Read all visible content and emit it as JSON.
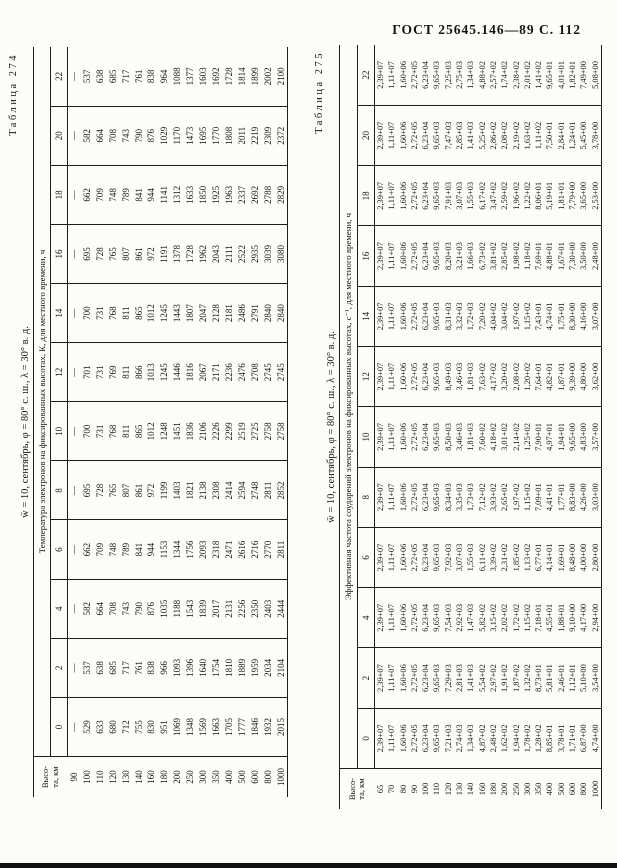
{
  "page_header": "ГОСТ 25645.146—89 С. 112",
  "tables": [
    {
      "caption": "Таблица 274",
      "title": "w̄ = 10, сентябрь, φ = 80° с. ш., λ = 30° в. д.",
      "subtitle": "Температура электронов на фиксированных высотах, К, для местного времени, ч",
      "row_header_line1": "Высо-",
      "row_header_line2": "та, км",
      "hours": [
        "0",
        "2",
        "4",
        "6",
        "8",
        "10",
        "12",
        "14",
        "16",
        "18",
        "20",
        "22"
      ],
      "rows": [
        {
          "alt": "90",
          "values": [
            "—",
            "—",
            "—",
            "—",
            "—",
            "—",
            "—",
            "—",
            "—",
            "—",
            "—",
            "—"
          ]
        },
        {
          "alt": "100",
          "values": [
            "529",
            "537",
            "582",
            "662",
            "695",
            "700",
            "701",
            "700",
            "695",
            "662",
            "582",
            "537"
          ]
        },
        {
          "alt": "110",
          "values": [
            "633",
            "638",
            "664",
            "709",
            "728",
            "731",
            "731",
            "731",
            "728",
            "709",
            "664",
            "638"
          ]
        },
        {
          "alt": "120",
          "values": [
            "680",
            "685",
            "708",
            "748",
            "765",
            "768",
            "769",
            "768",
            "765",
            "748",
            "708",
            "685"
          ]
        },
        {
          "alt": "130",
          "values": [
            "712",
            "717",
            "743",
            "789",
            "807",
            "811",
            "811",
            "811",
            "807",
            "789",
            "743",
            "717"
          ]
        },
        {
          "alt": "140",
          "values": [
            "755",
            "761",
            "790",
            "841",
            "861",
            "865",
            "866",
            "865",
            "861",
            "841",
            "790",
            "761"
          ]
        },
        {
          "alt": "160",
          "values": [
            "830",
            "838",
            "876",
            "944",
            "972",
            "1012",
            "1013",
            "1012",
            "972",
            "944",
            "876",
            "838"
          ]
        },
        {
          "alt": "180",
          "values": [
            "951",
            "966",
            "1035",
            "1153",
            "1199",
            "1248",
            "1245",
            "1245",
            "1191",
            "1141",
            "1029",
            "964"
          ]
        },
        {
          "alt": "200",
          "values": [
            "1069",
            "1093",
            "1188",
            "1344",
            "1403",
            "1451",
            "1446",
            "1443",
            "1378",
            "1312",
            "1170",
            "1088"
          ]
        },
        {
          "alt": "250",
          "values": [
            "1348",
            "1396",
            "1543",
            "1756",
            "1821",
            "1836",
            "1816",
            "1807",
            "1728",
            "1633",
            "1473",
            "1377"
          ]
        },
        {
          "alt": "300",
          "values": [
            "1569",
            "1640",
            "1839",
            "2093",
            "2138",
            "2106",
            "2067",
            "2047",
            "1962",
            "1850",
            "1695",
            "1603"
          ]
        },
        {
          "alt": "350",
          "values": [
            "1663",
            "1754",
            "2017",
            "2318",
            "2308",
            "2226",
            "2171",
            "2128",
            "2043",
            "1925",
            "1770",
            "1692"
          ]
        },
        {
          "alt": "400",
          "values": [
            "1705",
            "1810",
            "2131",
            "2471",
            "2414",
            "2299",
            "2236",
            "2181",
            "2111",
            "1963",
            "1808",
            "1728"
          ]
        },
        {
          "alt": "500",
          "values": [
            "1777",
            "1889",
            "2256",
            "2616",
            "2594",
            "2519",
            "2476",
            "2486",
            "2522",
            "2337",
            "2011",
            "1814"
          ]
        },
        {
          "alt": "600",
          "values": [
            "1846",
            "1959",
            "2350",
            "2716",
            "2748",
            "2725",
            "2708",
            "2791",
            "2935",
            "2692",
            "2219",
            "1899"
          ]
        },
        {
          "alt": "800",
          "values": [
            "1932",
            "2034",
            "2403",
            "2770",
            "2811",
            "2758",
            "2745",
            "2840",
            "3039",
            "2788",
            "2309",
            "2002"
          ]
        },
        {
          "alt": "1000",
          "values": [
            "2015",
            "2104",
            "2444",
            "2811",
            "2852",
            "2758",
            "2745",
            "2840",
            "3080",
            "2829",
            "2372",
            "2100"
          ]
        }
      ]
    },
    {
      "caption": "Таблица 275",
      "title": "w̄ = 10, сентябрь, φ = 80° с. ш., λ = 30° в. д.",
      "subtitle": "Эффективная частота соударений электронов на фиксированных высотах, с⁻¹, для местного времени, ч",
      "row_header_line1": "Высо-",
      "row_header_line2": "та, км",
      "hours": [
        "0",
        "2",
        "4",
        "6",
        "8",
        "10",
        "12",
        "14",
        "16",
        "18",
        "20",
        "22"
      ],
      "rows": [
        {
          "alt": "65",
          "values": [
            "2,39+07",
            "2,39+07",
            "2,39+07",
            "2,39+07",
            "2,39+07",
            "2,39+07",
            "2,39+07",
            "2,39+07",
            "2,39+07",
            "2,39+07",
            "2,39+07",
            "2,39+07"
          ]
        },
        {
          "alt": "70",
          "values": [
            "1,11+07",
            "1,11+07",
            "1,11+07",
            "1,11+07",
            "1,11+07",
            "1,11+07",
            "1,11+07",
            "1,11+07",
            "1,11+07",
            "1,11+07",
            "1,11+07",
            "1,11+07"
          ]
        },
        {
          "alt": "80",
          "values": [
            "1,60+06",
            "1,60+06",
            "1,60+06",
            "1,60+06",
            "1,60+06",
            "1,60+06",
            "1,60+06",
            "1,60+06",
            "1,60+06",
            "1,60+06",
            "1,60+06",
            "1,60+06"
          ]
        },
        {
          "alt": "90",
          "values": [
            "2,72+05",
            "2,72+05",
            "2,72+05",
            "2,72+05",
            "2,72+05",
            "2,72+05",
            "2,72+05",
            "2,72+05",
            "2,72+05",
            "2,72+05",
            "2,72+05",
            "2,72+05"
          ]
        },
        {
          "alt": "100",
          "values": [
            "6,23+04",
            "6,23+04",
            "6,23+04",
            "6,23+04",
            "6,23+04",
            "6,23+04",
            "6,23+04",
            "6,23+04",
            "6,23+04",
            "6,23+04",
            "6,23+04",
            "6,23+04"
          ]
        },
        {
          "alt": "110",
          "values": [
            "9,65+03",
            "9,65+03",
            "9,65+03",
            "9,65+03",
            "9,65+03",
            "9,65+03",
            "9,65+03",
            "9,65+03",
            "9,65+03",
            "9,65+03",
            "9,65+03",
            "9,65+03"
          ]
        },
        {
          "alt": "120",
          "values": [
            "7,21+03",
            "7,29+03",
            "7,54+03",
            "7,92+03",
            "8,34+03",
            "8,50+03",
            "8,49+03",
            "8,31+03",
            "8,20+03",
            "7,91+03",
            "7,47+03",
            "7,25+03"
          ]
        },
        {
          "alt": "130",
          "values": [
            "2,74+03",
            "2,81+03",
            "2,92+03",
            "3,07+03",
            "3,35+03",
            "3,46+03",
            "3,46+03",
            "3,32+03",
            "3,21+03",
            "3,07+03",
            "2,85+03",
            "2,75+03"
          ]
        },
        {
          "alt": "140",
          "values": [
            "1,34+03",
            "1,41+03",
            "1,47+03",
            "1,55+03",
            "1,73+03",
            "1,81+03",
            "1,81+03",
            "1,72+03",
            "1,66+03",
            "1,55+03",
            "1,41+03",
            "1,34+03"
          ]
        },
        {
          "alt": "160",
          "values": [
            "4,87+02",
            "5,54+02",
            "5,82+02",
            "6,11+02",
            "7,12+02",
            "7,60+02",
            "7,63+02",
            "7,20+02",
            "6,73+02",
            "6,17+02",
            "5,25+02",
            "4,88+02"
          ]
        },
        {
          "alt": "180",
          "values": [
            "2,48+02",
            "2,97+02",
            "3,15+02",
            "3,39+02",
            "3,93+02",
            "4,18+02",
            "4,17+02",
            "4,04+02",
            "3,81+02",
            "3,47+02",
            "2,86+02",
            "2,57+02"
          ]
        },
        {
          "alt": "200",
          "values": [
            "1,62+02",
            "1,91+02",
            "2,02+02",
            "2,31+02",
            "2,65+02",
            "3,01+02",
            "3,20+02",
            "3,04+02",
            "2,85+02",
            "2,59+02",
            "2,08+02",
            "1,74+02"
          ]
        },
        {
          "alt": "250",
          "values": [
            "1,94+02",
            "1,87+02",
            "1,72+02",
            "1,85+02",
            "1,97+02",
            "2,14+02",
            "2,08+02",
            "1,97+02",
            "1,98+02",
            "1,96+02",
            "2,19+02",
            "2,38+02"
          ]
        },
        {
          "alt": "300",
          "values": [
            "1,78+02",
            "1,32+02",
            "1,15+02",
            "1,13+02",
            "1,15+02",
            "1,25+02",
            "1,20+02",
            "1,15+02",
            "1,18+02",
            "1,22+02",
            "1,63+02",
            "2,01+02"
          ]
        },
        {
          "alt": "350",
          "values": [
            "1,28+02",
            "8,73+01",
            "7,18+01",
            "6,77+01",
            "7,09+01",
            "7,90+01",
            "7,64+01",
            "7,43+01",
            "7,69+01",
            "8,06+01",
            "1,11+02",
            "1,41+02"
          ]
        },
        {
          "alt": "400",
          "values": [
            "8,85+01",
            "5,81+01",
            "4,55+01",
            "4,14+01",
            "4,41+01",
            "4,97+01",
            "4,82+01",
            "4,74+01",
            "4,88+01",
            "5,19+01",
            "7,50+01",
            "9,65+01"
          ]
        },
        {
          "alt": "500",
          "values": [
            "3,78+01",
            "2,46+01",
            "1,88+01",
            "1,69+01",
            "1,77+01",
            "1,94+01",
            "1,87+01",
            "1,75+01",
            "1,67+01",
            "1,81+01",
            "2,84+01",
            "4,01+01"
          ]
        },
        {
          "alt": "600",
          "values": [
            "1,71+01",
            "1,12+01",
            "9,10+00",
            "8,48+00",
            "8,83+00",
            "9,65+00",
            "9,39+00",
            "8,30+00",
            "7,30+00",
            "7,79+00",
            "1,24+01",
            "1,82+01"
          ]
        },
        {
          "alt": "800",
          "values": [
            "6,87+00",
            "5,10+00",
            "4,17+00",
            "4,00+00",
            "4,26+00",
            "4,83+00",
            "4,80+00",
            "4,16+00",
            "3,50+00",
            "3,65+00",
            "5,45+00",
            "7,49+00"
          ]
        },
        {
          "alt": "1000",
          "values": [
            "4,74+00",
            "3,54+00",
            "2,94+00",
            "2,80+00",
            "3,03+00",
            "3,57+00",
            "3,62+00",
            "3,07+00",
            "2,48+00",
            "2,53+00",
            "3,78+00",
            "5,08+00"
          ]
        }
      ]
    }
  ]
}
